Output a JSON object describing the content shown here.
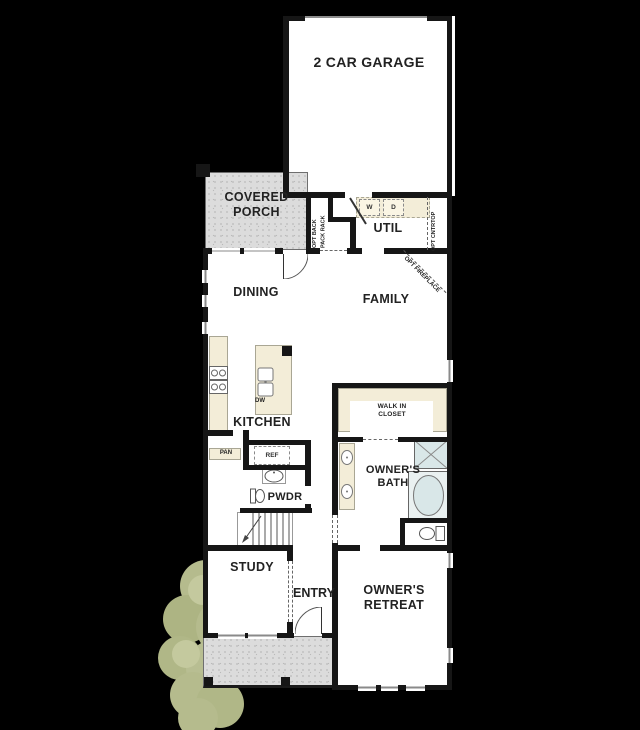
{
  "plan": {
    "rooms": {
      "garage": "2 CAR GARAGE",
      "covered_porch": [
        "COVERED",
        "PORCH"
      ],
      "util": "UTIL",
      "dining": "DINING",
      "family": "FAMILY",
      "kitchen": "KITCHEN",
      "pwdr": "PWDR",
      "walk_in_closet": [
        "WALK IN",
        "CLOSET"
      ],
      "owners_bath": [
        "OWNER'S",
        "BATH"
      ],
      "study": "STUDY",
      "entry": "ENTRY",
      "owners_retreat": [
        "OWNER'S",
        "RETREAT"
      ]
    },
    "fixtures": {
      "washer": "W",
      "dryer": "D",
      "dishwasher": "DW",
      "pantry": "PAN",
      "refrigerator": "REF"
    },
    "annotations": {
      "back_pack_rack": [
        "OPT BACK",
        "PACK RACK"
      ],
      "countertop": "OPT CNTRTOP",
      "fireplace": "OPT FIREPLACE"
    },
    "colors": {
      "background": "#000000",
      "floor": "#ffffff",
      "wall": "#161616",
      "counter": "#f3edd8",
      "porch": "#dcdcdc",
      "fixture": "#d9e7e8",
      "tree": "#b5bb8d"
    }
  }
}
